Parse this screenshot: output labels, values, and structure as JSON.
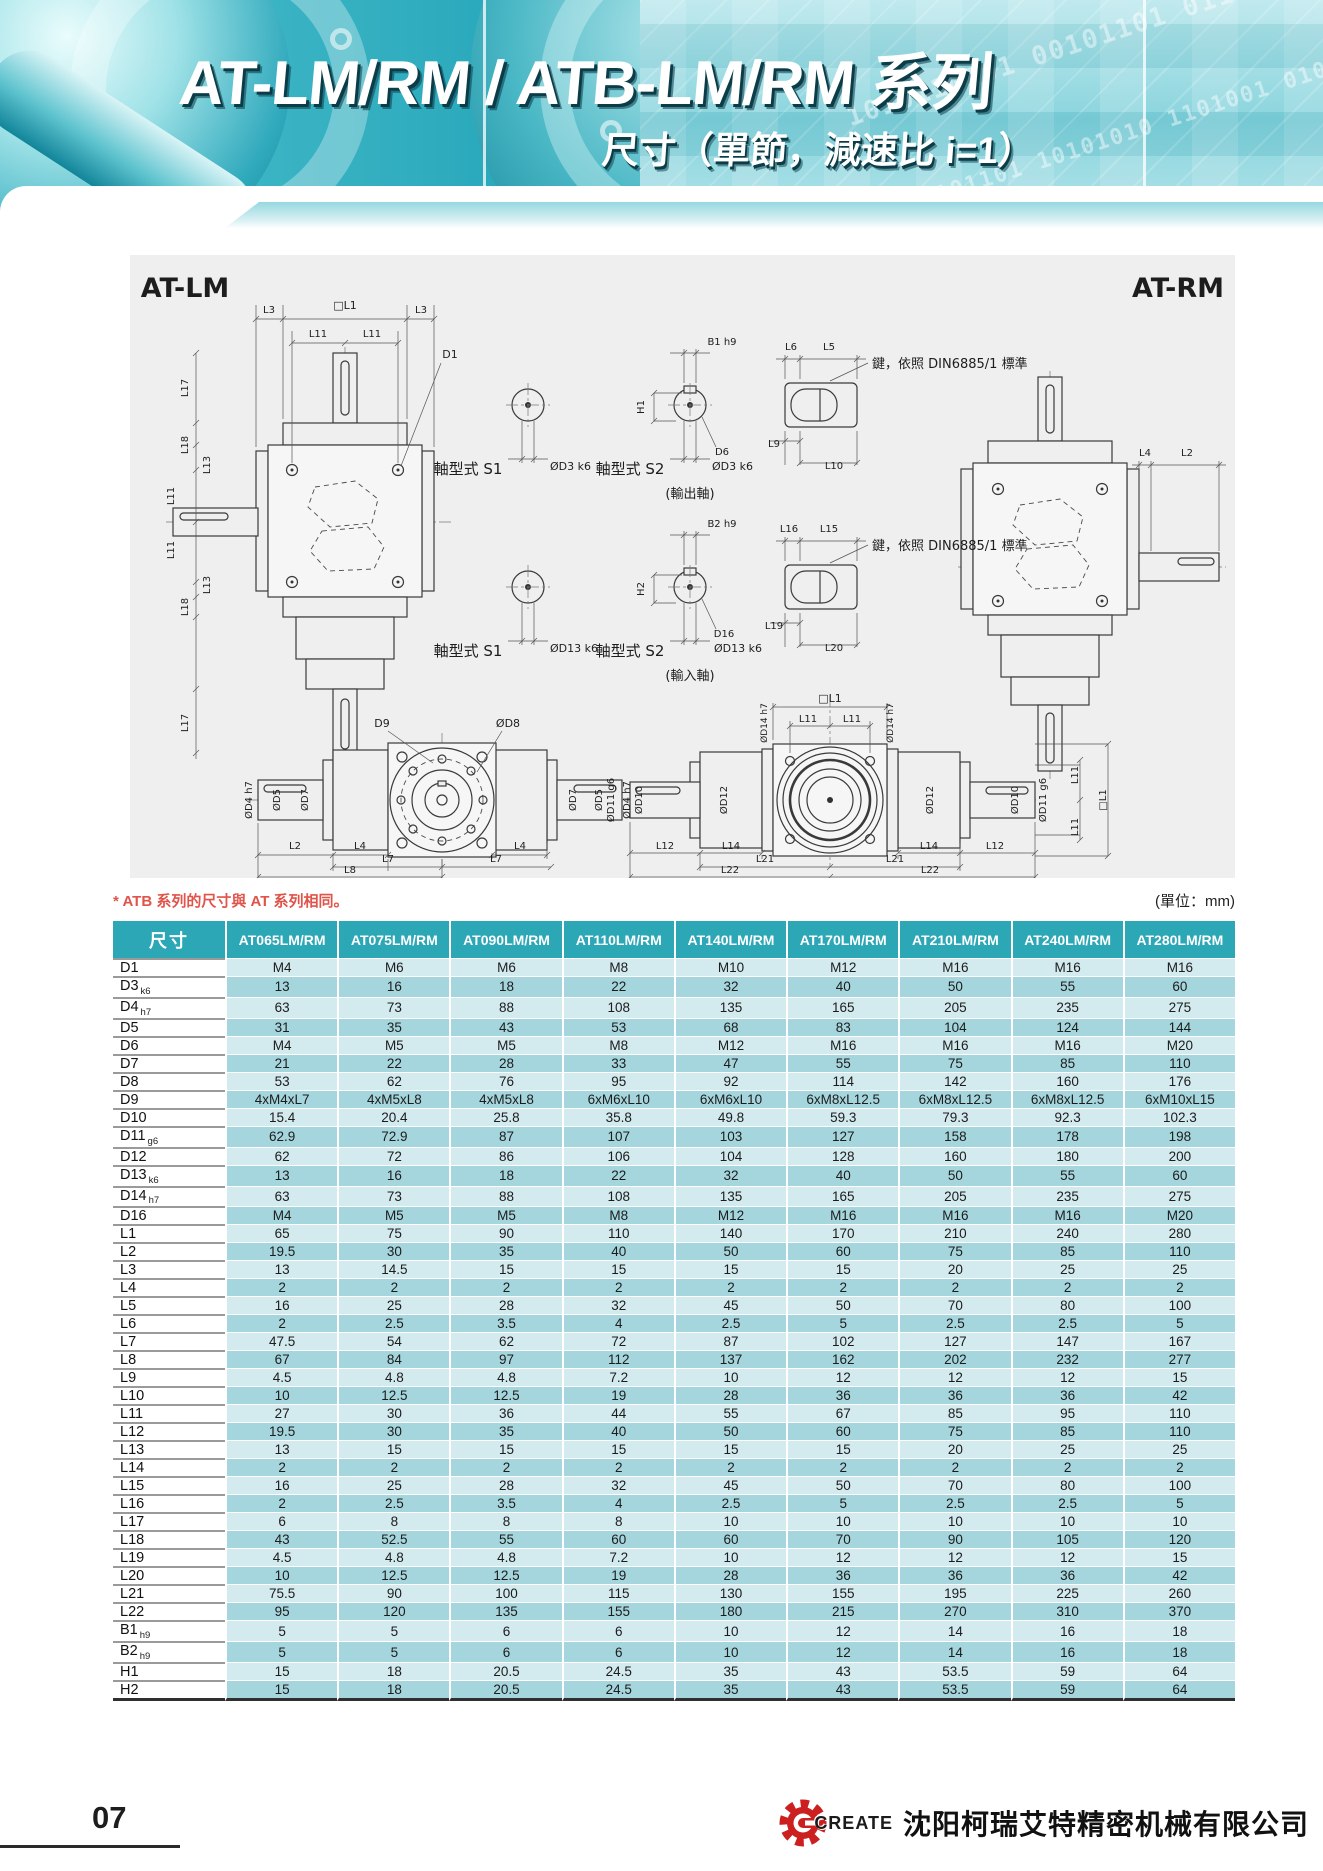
{
  "header": {
    "title": "AT-LM/RM / ATB-LM/RM 系列",
    "subtitle": "尺寸（單節，減速比 i=1）",
    "binary1": "1010110101 00101101 0110101",
    "binary2": "0101101 10101010 1101001 0101"
  },
  "drawing": {
    "labels": [
      {
        "t": "AT-LM",
        "x": 55,
        "y": 42,
        "s": 27,
        "w": "bold"
      },
      {
        "t": "AT-RM",
        "x": 1048,
        "y": 42,
        "s": 27,
        "w": "bold"
      },
      {
        "t": "L3",
        "x": 139,
        "y": 58,
        "s": 10
      },
      {
        "t": "□L1",
        "x": 215,
        "y": 54,
        "s": 11
      },
      {
        "t": "L3",
        "x": 291,
        "y": 58,
        "s": 10
      },
      {
        "t": "L11",
        "x": 188,
        "y": 82,
        "s": 10
      },
      {
        "t": "L11",
        "x": 242,
        "y": 82,
        "s": 10
      },
      {
        "t": "D1",
        "x": 320,
        "y": 103,
        "s": 11
      },
      {
        "t": "L17",
        "x": 58,
        "y": 133,
        "s": 10,
        "r": -90
      },
      {
        "t": "L18",
        "x": 58,
        "y": 190,
        "s": 10,
        "r": -90
      },
      {
        "t": "L13",
        "x": 80,
        "y": 210,
        "s": 10,
        "r": -90
      },
      {
        "t": "L11",
        "x": 44,
        "y": 241,
        "s": 10,
        "r": -90
      },
      {
        "t": "L11",
        "x": 44,
        "y": 295,
        "s": 10,
        "r": -90
      },
      {
        "t": "L13",
        "x": 80,
        "y": 330,
        "s": 10,
        "r": -90
      },
      {
        "t": "L18",
        "x": 58,
        "y": 352,
        "s": 10,
        "r": -90
      },
      {
        "t": "L17",
        "x": 58,
        "y": 468,
        "s": 10,
        "r": -90
      },
      {
        "t": "軸型式 S1",
        "x": 338,
        "y": 219,
        "s": 15
      },
      {
        "t": "ØD3 k6",
        "x": 420,
        "y": 215,
        "s": 11,
        "a": "s"
      },
      {
        "t": "B1 h9",
        "x": 592,
        "y": 90,
        "s": 10
      },
      {
        "t": "H1",
        "x": 514,
        "y": 152,
        "s": 10,
        "r": -90
      },
      {
        "t": "D6",
        "x": 592,
        "y": 200,
        "s": 10
      },
      {
        "t": "軸型式 S2",
        "x": 500,
        "y": 219,
        "s": 15
      },
      {
        "t": "ØD3 k6",
        "x": 582,
        "y": 215,
        "s": 11,
        "a": "s"
      },
      {
        "t": "(輸出軸)",
        "x": 560,
        "y": 243,
        "s": 13
      },
      {
        "t": "L6",
        "x": 661,
        "y": 95,
        "s": 10
      },
      {
        "t": "L5",
        "x": 699,
        "y": 95,
        "s": 10
      },
      {
        "t": "鍵，依照 DIN6885/1 標準",
        "x": 742,
        "y": 113,
        "s": 13,
        "a": "s"
      },
      {
        "t": "L9",
        "x": 644,
        "y": 192,
        "s": 10
      },
      {
        "t": "L10",
        "x": 704,
        "y": 214,
        "s": 10
      },
      {
        "t": "軸型式 S1",
        "x": 338,
        "y": 401,
        "s": 15
      },
      {
        "t": "ØD13 k6",
        "x": 420,
        "y": 397,
        "s": 11,
        "a": "s"
      },
      {
        "t": "B2 h9",
        "x": 592,
        "y": 272,
        "s": 10
      },
      {
        "t": "H2",
        "x": 514,
        "y": 334,
        "s": 10,
        "r": -90
      },
      {
        "t": "D16",
        "x": 594,
        "y": 382,
        "s": 10
      },
      {
        "t": "軸型式 S2",
        "x": 500,
        "y": 401,
        "s": 15
      },
      {
        "t": "ØD13 k6",
        "x": 584,
        "y": 397,
        "s": 11,
        "a": "s"
      },
      {
        "t": "(輸入軸)",
        "x": 560,
        "y": 425,
        "s": 13
      },
      {
        "t": "L16",
        "x": 659,
        "y": 277,
        "s": 10
      },
      {
        "t": "L15",
        "x": 699,
        "y": 277,
        "s": 10
      },
      {
        "t": "鍵，依照 DIN6885/1 標準",
        "x": 742,
        "y": 295,
        "s": 13,
        "a": "s"
      },
      {
        "t": "L19",
        "x": 644,
        "y": 374,
        "s": 10
      },
      {
        "t": "L20",
        "x": 704,
        "y": 396,
        "s": 10
      },
      {
        "t": "L4",
        "x": 1015,
        "y": 201,
        "s": 10
      },
      {
        "t": "L2",
        "x": 1057,
        "y": 201,
        "s": 10
      },
      {
        "t": "D9",
        "x": 252,
        "y": 472,
        "s": 11
      },
      {
        "t": "ØD8",
        "x": 378,
        "y": 472,
        "s": 11
      },
      {
        "t": "ØD4 h7",
        "x": 122,
        "y": 545,
        "s": 10,
        "r": -90
      },
      {
        "t": "ØD5",
        "x": 150,
        "y": 545,
        "s": 10,
        "r": -90
      },
      {
        "t": "ØD7",
        "x": 178,
        "y": 545,
        "s": 10,
        "r": -90
      },
      {
        "t": "ØD7",
        "x": 446,
        "y": 545,
        "s": 10,
        "r": -90
      },
      {
        "t": "ØD5",
        "x": 472,
        "y": 545,
        "s": 10,
        "r": -90
      },
      {
        "t": "ØD4 h7",
        "x": 500,
        "y": 545,
        "s": 10,
        "r": -90
      },
      {
        "t": "L2",
        "x": 165,
        "y": 594,
        "s": 10
      },
      {
        "t": "L4",
        "x": 230,
        "y": 594,
        "s": 10
      },
      {
        "t": "L4",
        "x": 390,
        "y": 594,
        "s": 10
      },
      {
        "t": "L7",
        "x": 258,
        "y": 607,
        "s": 10
      },
      {
        "t": "L7",
        "x": 366,
        "y": 607,
        "s": 10
      },
      {
        "t": "L8",
        "x": 220,
        "y": 618,
        "s": 10
      },
      {
        "t": "□L1",
        "x": 700,
        "y": 447,
        "s": 11
      },
      {
        "t": "L11",
        "x": 678,
        "y": 467,
        "s": 10
      },
      {
        "t": "L11",
        "x": 722,
        "y": 467,
        "s": 10
      },
      {
        "t": "ØD14 h7",
        "x": 637,
        "y": 468,
        "s": 9,
        "r": -90
      },
      {
        "t": "ØD14 h7",
        "x": 763,
        "y": 468,
        "s": 9,
        "r": -90
      },
      {
        "t": "ØD11 g6",
        "x": 484,
        "y": 545,
        "s": 10,
        "r": -90
      },
      {
        "t": "ØD10",
        "x": 512,
        "y": 545,
        "s": 10,
        "r": -90
      },
      {
        "t": "ØD12",
        "x": 597,
        "y": 545,
        "s": 10,
        "r": -90
      },
      {
        "t": "ØD12",
        "x": 803,
        "y": 545,
        "s": 10,
        "r": -90
      },
      {
        "t": "ØD10",
        "x": 888,
        "y": 545,
        "s": 10,
        "r": -90
      },
      {
        "t": "ØD11 g6",
        "x": 916,
        "y": 545,
        "s": 10,
        "r": -90
      },
      {
        "t": "L11",
        "x": 948,
        "y": 520,
        "s": 10,
        "r": -90
      },
      {
        "t": "L11",
        "x": 948,
        "y": 572,
        "s": 10,
        "r": -90
      },
      {
        "t": "□L1",
        "x": 976,
        "y": 545,
        "s": 10,
        "r": -90
      },
      {
        "t": "L12",
        "x": 535,
        "y": 594,
        "s": 10
      },
      {
        "t": "L14",
        "x": 601,
        "y": 594,
        "s": 10
      },
      {
        "t": "L14",
        "x": 799,
        "y": 594,
        "s": 10
      },
      {
        "t": "L12",
        "x": 865,
        "y": 594,
        "s": 10
      },
      {
        "t": "L21",
        "x": 635,
        "y": 607,
        "s": 10
      },
      {
        "t": "L21",
        "x": 765,
        "y": 607,
        "s": 10
      },
      {
        "t": "L22",
        "x": 600,
        "y": 618,
        "s": 10
      },
      {
        "t": "L22",
        "x": 800,
        "y": 618,
        "s": 10
      }
    ]
  },
  "note": {
    "text": "* ATB 系列的尺寸與 AT 系列相同。",
    "unit": "(單位：mm)"
  },
  "table": {
    "header": [
      "尺寸",
      "AT065LM/RM",
      "AT075LM/RM",
      "AT090LM/RM",
      "AT110LM/RM",
      "AT140LM/RM",
      "AT170LM/RM",
      "AT210LM/RM",
      "AT240LM/RM",
      "AT280LM/RM"
    ],
    "rows": [
      {
        "label": "D1",
        "sub": "",
        "values": [
          "M4",
          "M6",
          "M6",
          "M8",
          "M10",
          "M12",
          "M16",
          "M16",
          "M16"
        ]
      },
      {
        "label": "D3",
        "sub": "k6",
        "values": [
          "13",
          "16",
          "18",
          "22",
          "32",
          "40",
          "50",
          "55",
          "60"
        ]
      },
      {
        "label": "D4",
        "sub": "h7",
        "values": [
          "63",
          "73",
          "88",
          "108",
          "135",
          "165",
          "205",
          "235",
          "275"
        ]
      },
      {
        "label": "D5",
        "sub": "",
        "values": [
          "31",
          "35",
          "43",
          "53",
          "68",
          "83",
          "104",
          "124",
          "144"
        ]
      },
      {
        "label": "D6",
        "sub": "",
        "values": [
          "M4",
          "M5",
          "M5",
          "M8",
          "M12",
          "M16",
          "M16",
          "M16",
          "M20"
        ]
      },
      {
        "label": "D7",
        "sub": "",
        "values": [
          "21",
          "22",
          "28",
          "33",
          "47",
          "55",
          "75",
          "85",
          "110"
        ]
      },
      {
        "label": "D8",
        "sub": "",
        "values": [
          "53",
          "62",
          "76",
          "95",
          "92",
          "114",
          "142",
          "160",
          "176"
        ]
      },
      {
        "label": "D9",
        "sub": "",
        "values": [
          "4xM4xL7",
          "4xM5xL8",
          "4xM5xL8",
          "6xM6xL10",
          "6xM6xL10",
          "6xM8xL12.5",
          "6xM8xL12.5",
          "6xM8xL12.5",
          "6xM10xL15"
        ]
      },
      {
        "label": "D10",
        "sub": "",
        "values": [
          "15.4",
          "20.4",
          "25.8",
          "35.8",
          "49.8",
          "59.3",
          "79.3",
          "92.3",
          "102.3"
        ]
      },
      {
        "label": "D11",
        "sub": "g6",
        "values": [
          "62.9",
          "72.9",
          "87",
          "107",
          "103",
          "127",
          "158",
          "178",
          "198"
        ]
      },
      {
        "label": "D12",
        "sub": "",
        "values": [
          "62",
          "72",
          "86",
          "106",
          "104",
          "128",
          "160",
          "180",
          "200"
        ]
      },
      {
        "label": "D13",
        "sub": "k6",
        "values": [
          "13",
          "16",
          "18",
          "22",
          "32",
          "40",
          "50",
          "55",
          "60"
        ]
      },
      {
        "label": "D14",
        "sub": "h7",
        "values": [
          "63",
          "73",
          "88",
          "108",
          "135",
          "165",
          "205",
          "235",
          "275"
        ]
      },
      {
        "label": "D16",
        "sub": "",
        "values": [
          "M4",
          "M5",
          "M5",
          "M8",
          "M12",
          "M16",
          "M16",
          "M16",
          "M20"
        ]
      },
      {
        "label": "L1",
        "sub": "",
        "values": [
          "65",
          "75",
          "90",
          "110",
          "140",
          "170",
          "210",
          "240",
          "280"
        ]
      },
      {
        "label": "L2",
        "sub": "",
        "values": [
          "19.5",
          "30",
          "35",
          "40",
          "50",
          "60",
          "75",
          "85",
          "110"
        ]
      },
      {
        "label": "L3",
        "sub": "",
        "values": [
          "13",
          "14.5",
          "15",
          "15",
          "15",
          "15",
          "20",
          "25",
          "25"
        ]
      },
      {
        "label": "L4",
        "sub": "",
        "values": [
          "2",
          "2",
          "2",
          "2",
          "2",
          "2",
          "2",
          "2",
          "2"
        ]
      },
      {
        "label": "L5",
        "sub": "",
        "values": [
          "16",
          "25",
          "28",
          "32",
          "45",
          "50",
          "70",
          "80",
          "100"
        ]
      },
      {
        "label": "L6",
        "sub": "",
        "values": [
          "2",
          "2.5",
          "3.5",
          "4",
          "2.5",
          "5",
          "2.5",
          "2.5",
          "5"
        ]
      },
      {
        "label": "L7",
        "sub": "",
        "values": [
          "47.5",
          "54",
          "62",
          "72",
          "87",
          "102",
          "127",
          "147",
          "167"
        ]
      },
      {
        "label": "L8",
        "sub": "",
        "values": [
          "67",
          "84",
          "97",
          "112",
          "137",
          "162",
          "202",
          "232",
          "277"
        ]
      },
      {
        "label": "L9",
        "sub": "",
        "values": [
          "4.5",
          "4.8",
          "4.8",
          "7.2",
          "10",
          "12",
          "12",
          "12",
          "15"
        ]
      },
      {
        "label": "L10",
        "sub": "",
        "values": [
          "10",
          "12.5",
          "12.5",
          "19",
          "28",
          "36",
          "36",
          "36",
          "42"
        ]
      },
      {
        "label": "L11",
        "sub": "",
        "values": [
          "27",
          "30",
          "36",
          "44",
          "55",
          "67",
          "85",
          "95",
          "110"
        ]
      },
      {
        "label": "L12",
        "sub": "",
        "values": [
          "19.5",
          "30",
          "35",
          "40",
          "50",
          "60",
          "75",
          "85",
          "110"
        ]
      },
      {
        "label": "L13",
        "sub": "",
        "values": [
          "13",
          "15",
          "15",
          "15",
          "15",
          "15",
          "20",
          "25",
          "25"
        ]
      },
      {
        "label": "L14",
        "sub": "",
        "values": [
          "2",
          "2",
          "2",
          "2",
          "2",
          "2",
          "2",
          "2",
          "2"
        ]
      },
      {
        "label": "L15",
        "sub": "",
        "values": [
          "16",
          "25",
          "28",
          "32",
          "45",
          "50",
          "70",
          "80",
          "100"
        ]
      },
      {
        "label": "L16",
        "sub": "",
        "values": [
          "2",
          "2.5",
          "3.5",
          "4",
          "2.5",
          "5",
          "2.5",
          "2.5",
          "5"
        ]
      },
      {
        "label": "L17",
        "sub": "",
        "values": [
          "6",
          "8",
          "8",
          "8",
          "10",
          "10",
          "10",
          "10",
          "10"
        ]
      },
      {
        "label": "L18",
        "sub": "",
        "values": [
          "43",
          "52.5",
          "55",
          "60",
          "60",
          "70",
          "90",
          "105",
          "120"
        ]
      },
      {
        "label": "L19",
        "sub": "",
        "values": [
          "4.5",
          "4.8",
          "4.8",
          "7.2",
          "10",
          "12",
          "12",
          "12",
          "15"
        ]
      },
      {
        "label": "L20",
        "sub": "",
        "values": [
          "10",
          "12.5",
          "12.5",
          "19",
          "28",
          "36",
          "36",
          "36",
          "42"
        ]
      },
      {
        "label": "L21",
        "sub": "",
        "values": [
          "75.5",
          "90",
          "100",
          "115",
          "130",
          "155",
          "195",
          "225",
          "260"
        ]
      },
      {
        "label": "L22",
        "sub": "",
        "values": [
          "95",
          "120",
          "135",
          "155",
          "180",
          "215",
          "270",
          "310",
          "370"
        ]
      },
      {
        "label": "B1",
        "sub": "h9",
        "values": [
          "5",
          "5",
          "6",
          "6",
          "10",
          "12",
          "14",
          "16",
          "18"
        ]
      },
      {
        "label": "B2",
        "sub": "h9",
        "values": [
          "5",
          "5",
          "6",
          "6",
          "10",
          "12",
          "14",
          "16",
          "18"
        ]
      },
      {
        "label": "H1",
        "sub": "",
        "values": [
          "15",
          "18",
          "20.5",
          "24.5",
          "35",
          "43",
          "53.5",
          "59",
          "64"
        ]
      },
      {
        "label": "H2",
        "sub": "",
        "values": [
          "15",
          "18",
          "20.5",
          "24.5",
          "35",
          "43",
          "53.5",
          "59",
          "64"
        ]
      }
    ]
  },
  "footer": {
    "page": "07",
    "logo_text": "CREATE",
    "company": "沈阳柯瑞艾特精密机械有限公司"
  },
  "colors": {
    "table_header": "#2ba7b6",
    "row_light": "#d3eaee",
    "row_dark": "#a6d6dd",
    "note_red": "#e0544a",
    "accent_teal": "#1b9cb0",
    "logo_red": "#cc2020"
  }
}
